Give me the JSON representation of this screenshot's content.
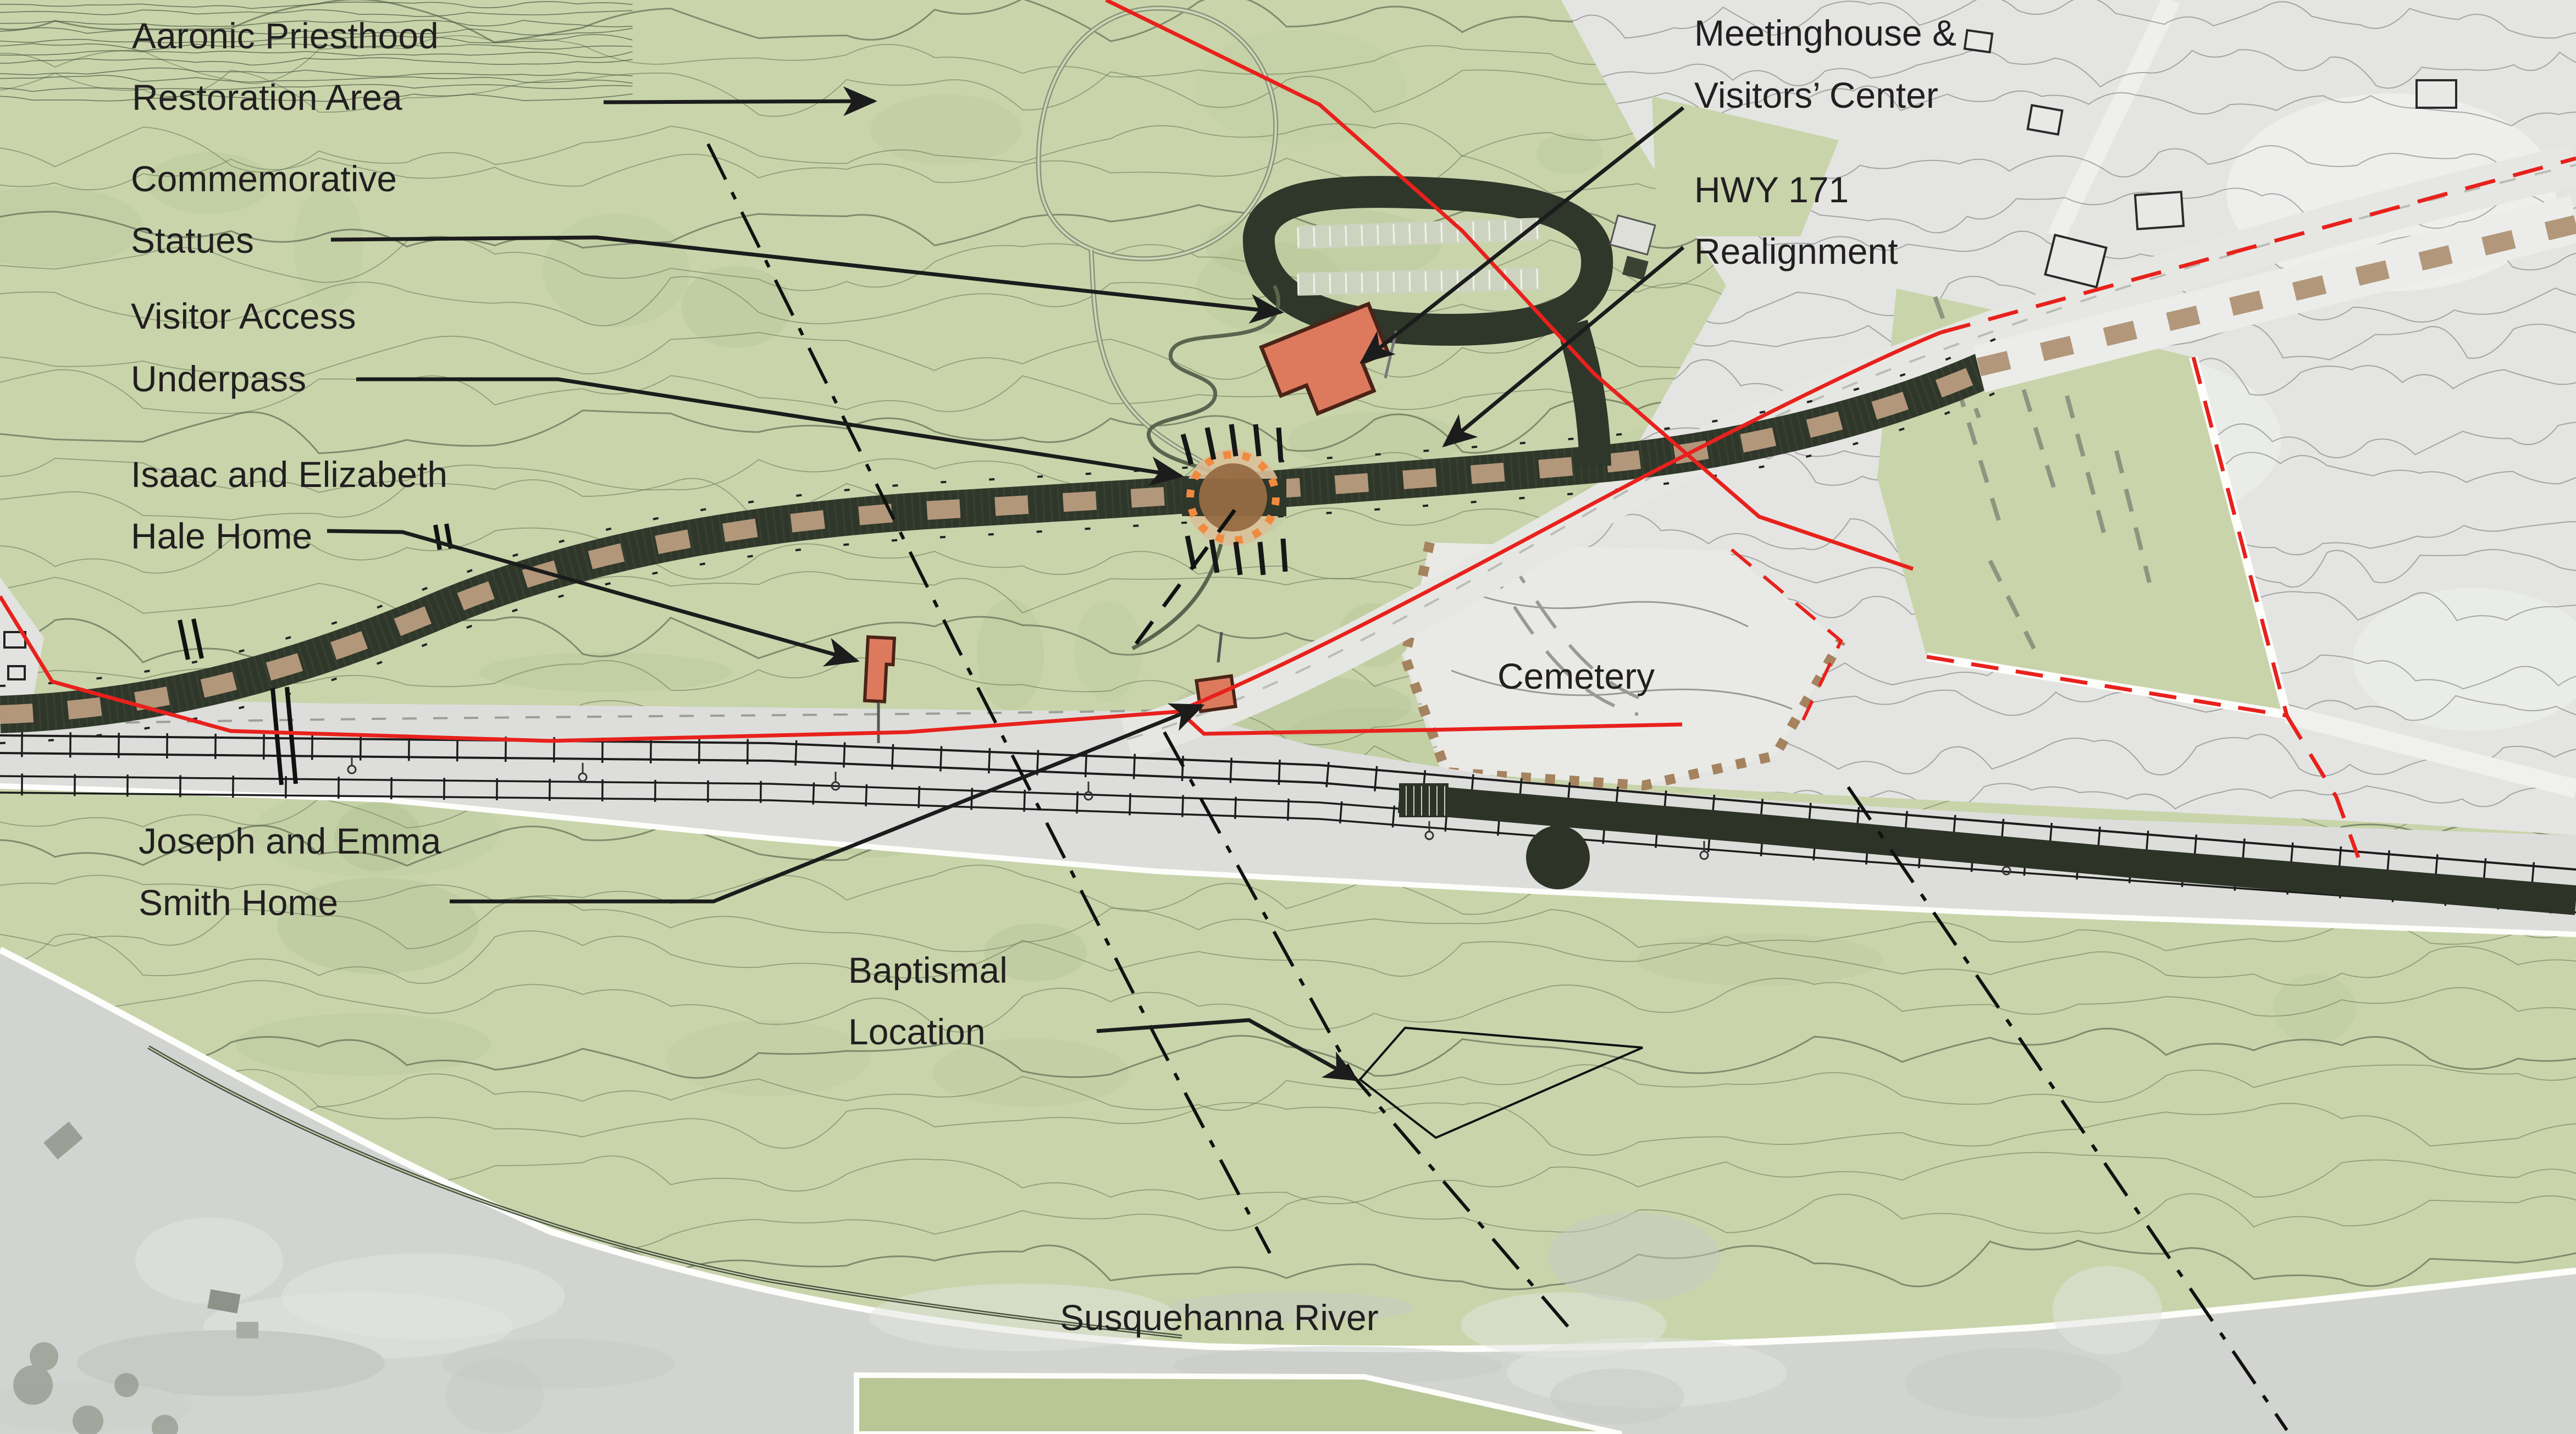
{
  "map": {
    "title": "Priesthood Restoration Site plan map",
    "labels": {
      "aaronic": {
        "line1": "Aaronic Priesthood",
        "line2": "Restoration Area"
      },
      "commemorative": {
        "line1": "Commemorative",
        "line2": "Statues"
      },
      "visitor": {
        "line1": "Visitor Access",
        "line2": "Underpass"
      },
      "isaac": {
        "line1": "Isaac and Elizabeth",
        "line2": "Hale Home"
      },
      "meetinghouse": {
        "line1": "Meetinghouse &",
        "line2": "Visitors’ Center"
      },
      "hwy": {
        "line1": "HWY 171",
        "line2": "Realignment"
      },
      "cemetery": {
        "text": "Cemetery"
      },
      "joseph": {
        "line1": "Joseph and Emma",
        "line2": "Smith Home"
      },
      "baptismal": {
        "line1": "Baptismal",
        "line2": "Location"
      },
      "river": {
        "text": "Susquehanna River"
      }
    },
    "colors": {
      "land_green": "#c9d4ab",
      "contour_olive": "#6b7a58",
      "aerial_gray": "#e4e5e2",
      "river_gray": "#d2d4d1",
      "corridor_gray": "#dddedb",
      "road_dark": "#2f362a",
      "road_dash_tan": "#b2977a",
      "existing_road": "#e6e7e3",
      "building_salmon": "#dd7a5e",
      "building_outline": "#4a2417",
      "boundary_red": "#e8211c",
      "cemetery_fill": "#e9eae6",
      "cemetery_dot_brown": "#a5835f",
      "underpass_orange": "#f08a3e",
      "underpass_brown": "#966b42",
      "label_black": "#231f20",
      "leader_black": "#1c1c1c",
      "shoreline_white": "#fdfdfb",
      "island_green": "#b8c795"
    }
  }
}
